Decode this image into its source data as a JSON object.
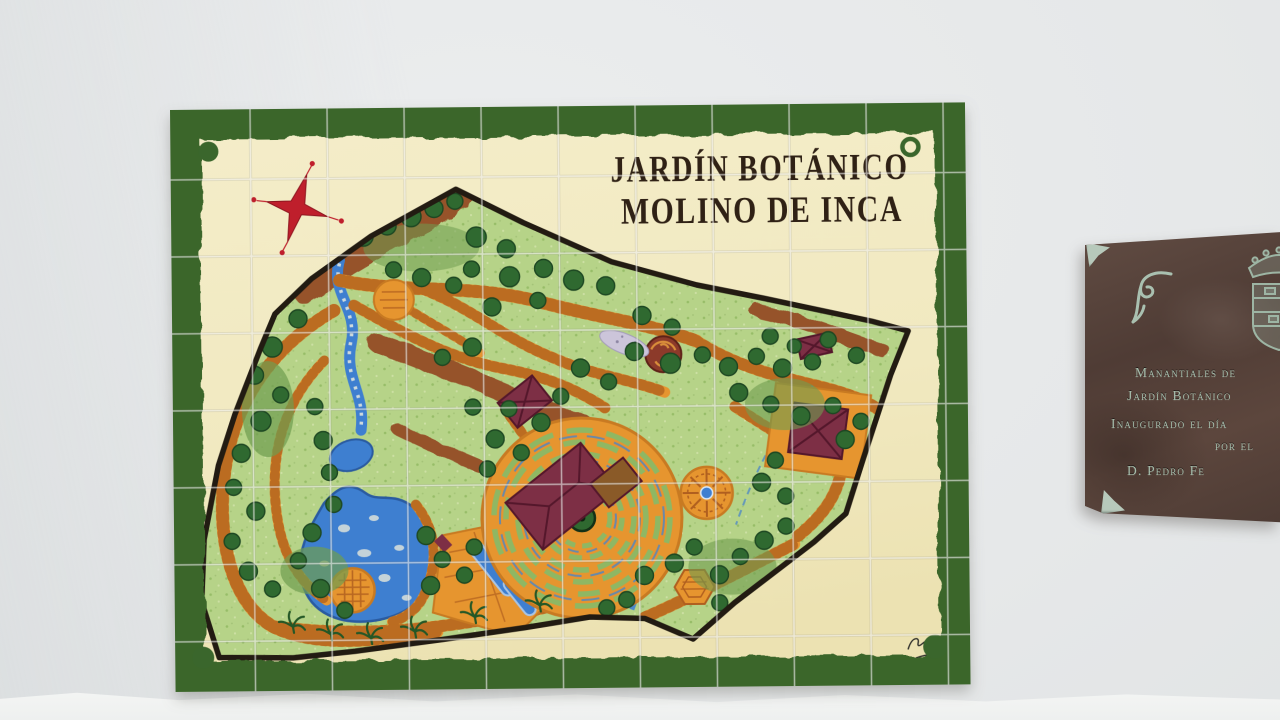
{
  "scene": {
    "wall_color": "#e6e8e9",
    "wall_bottom_strip_color": "#f4f5f4"
  },
  "mural": {
    "title_line1": "JARDÍN BOTÁNICO",
    "title_line2": "MOLINO DE INCA",
    "title_color": "#2f2115",
    "tile_color": "#f1e9c0",
    "border_color": "#3a662c",
    "grout_color": "#ffffff",
    "icons": {
      "compass_rose": "red-four-point-star",
      "corner_ornaments": "green-circle-dots",
      "artist_signature": "illegible-handwritten-signature"
    },
    "map": {
      "palette": {
        "grass": "#b6d388",
        "tree": "#2f6930",
        "path": "#e6952f",
        "brick_tick": "#a85c1c",
        "water": "#3e7fd0",
        "building": "#7d2f45",
        "slope": "#96522a",
        "boundary": "#221b12",
        "star_red": "#bf1f2c"
      },
      "features": [
        "garden-boundary",
        "stream-cascade",
        "rocky-lake",
        "central-labyrinth",
        "round-plaza",
        "hexagonal-kiosk",
        "lake-rotunda",
        "mill-building",
        "diamond-pavilion",
        "small-pavilion",
        "spiral-feature",
        "canal-pools",
        "brick-path-network",
        "slope-bands",
        "tree-groves",
        "palm-walk"
      ]
    }
  },
  "plaque": {
    "body_color": "#54423a",
    "text_color": "#a5bcab",
    "icons": {
      "crest": "crowned-coat-of-arms",
      "corner_mounts": "metal-corner-brackets",
      "flourish": "scroll-ornament"
    },
    "lines": [
      "Manantiales de",
      "Jardín Botánico",
      "Inaugurado el día",
      "por el",
      "D. Pedro Fe"
    ]
  }
}
